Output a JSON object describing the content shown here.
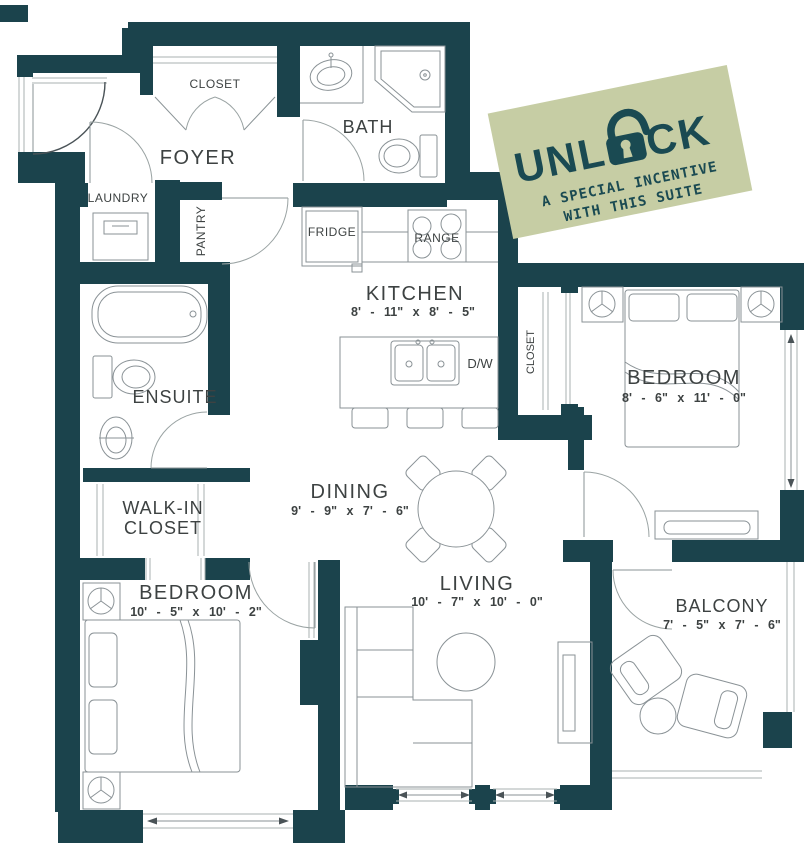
{
  "colors": {
    "wall": "#1b434c",
    "badge_bg": "#c6cda4",
    "badge_text": "#1a4a52",
    "line": "#8a9296"
  },
  "rooms": {
    "foyer": {
      "label": "FOYER"
    },
    "foyer_closet": {
      "label": "CLOSET"
    },
    "bath": {
      "label": "BATH"
    },
    "laundry": {
      "label": "LAUNDRY"
    },
    "pantry": {
      "label": "PANTRY"
    },
    "kitchen": {
      "label": "KITCHEN",
      "dims": "8' - 11\" x 8' - 5\""
    },
    "dining": {
      "label": "DINING",
      "dims": "9' - 9\" x 7' - 6\""
    },
    "living": {
      "label": "LIVING",
      "dims": "10' - 7\" x 10' - 0\""
    },
    "ensuite": {
      "label": "ENSUITE"
    },
    "walk_in_closet": {
      "line1": "WALK-IN",
      "line2": "CLOSET"
    },
    "bedroom_main": {
      "label": "BEDROOM",
      "dims": "8' - 6\" x 11' - 0\""
    },
    "bedroom_main_closet": {
      "label": "CLOSET"
    },
    "bedroom_second": {
      "label": "BEDROOM",
      "dims": "10' - 5\" x 10' - 2\""
    },
    "balcony": {
      "label": "BALCONY",
      "dims": "7' - 5\" x 7' - 6\""
    }
  },
  "appliances": {
    "fridge": "FRIDGE",
    "range": "RANGE",
    "dishwasher": "D/W"
  },
  "badge": {
    "title_full": "UNLOCK",
    "title_left": "UNL",
    "title_right": "CK",
    "line1": "A SPECIAL INCENTIVE",
    "line2": "WITH THIS SUITE"
  }
}
